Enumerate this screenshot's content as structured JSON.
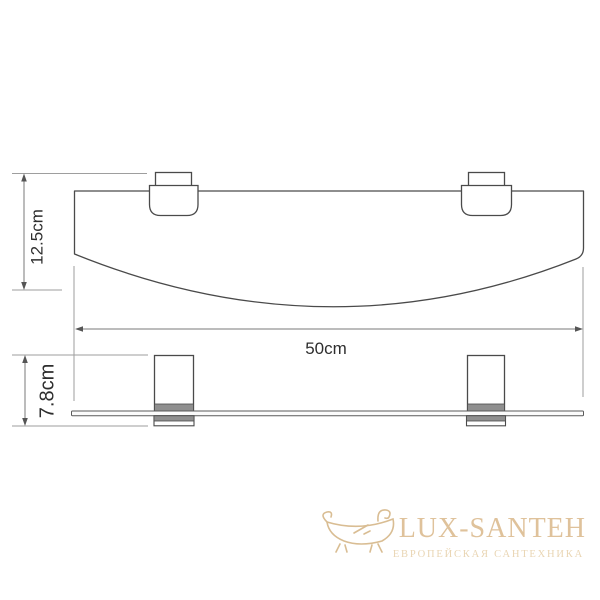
{
  "drawing": {
    "subject": "wall-mounted glass shelf with two brackets, top view and front view",
    "dimensions": {
      "depth": "12.5cm",
      "width": "50cm",
      "height": "7.8cm"
    },
    "colors": {
      "outline": "#4a4a4a",
      "dimension_line": "#7a7a7a",
      "extension_line": "#9e9e9e",
      "bracket_band": "#8f8f8f",
      "label_text": "#2e2e2e"
    }
  },
  "watermark": {
    "brand": "LUX-SANTEH",
    "tagline": "ЕВРОПЕЙСКАЯ САНТЕХНИКА",
    "brand_color": "#dfc29b",
    "tagline_color": "#e9d5b3",
    "icon": "bathtub-icon"
  }
}
